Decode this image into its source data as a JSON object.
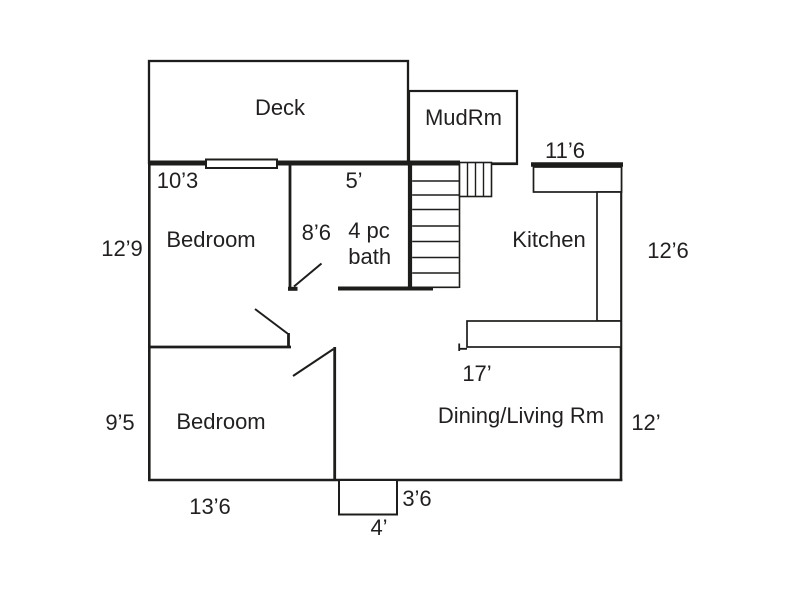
{
  "title": "Main floor plan",
  "colors": {
    "background": "#ffffff",
    "wall": "#1d1d1b",
    "text": "#221f20"
  },
  "rooms": {
    "deck": {
      "label": "Deck"
    },
    "mudroom": {
      "label": "MudRm"
    },
    "bedroom_upper": {
      "label": "Bedroom"
    },
    "bath": {
      "label_line1": "4 pc",
      "label_line2": "bath"
    },
    "kitchen": {
      "label": "Kitchen"
    },
    "bedroom_lower": {
      "label": "Bedroom"
    },
    "dining_living": {
      "label": "Dining/Living Rm"
    }
  },
  "dimensions": {
    "bedroom_upper_width": "10’3",
    "bedroom_upper_depth": "12’9",
    "bath_width": "5’",
    "bath_depth": "8’6",
    "kitchen_width": "11’6",
    "kitchen_depth": "12’6",
    "bedroom_lower_depth": "9’5",
    "bedroom_lower_width": "13’6",
    "dining_width": "17’",
    "dining_depth": "12’",
    "entry_steps_depth": "3’6",
    "entry_steps_width": "4’"
  }
}
